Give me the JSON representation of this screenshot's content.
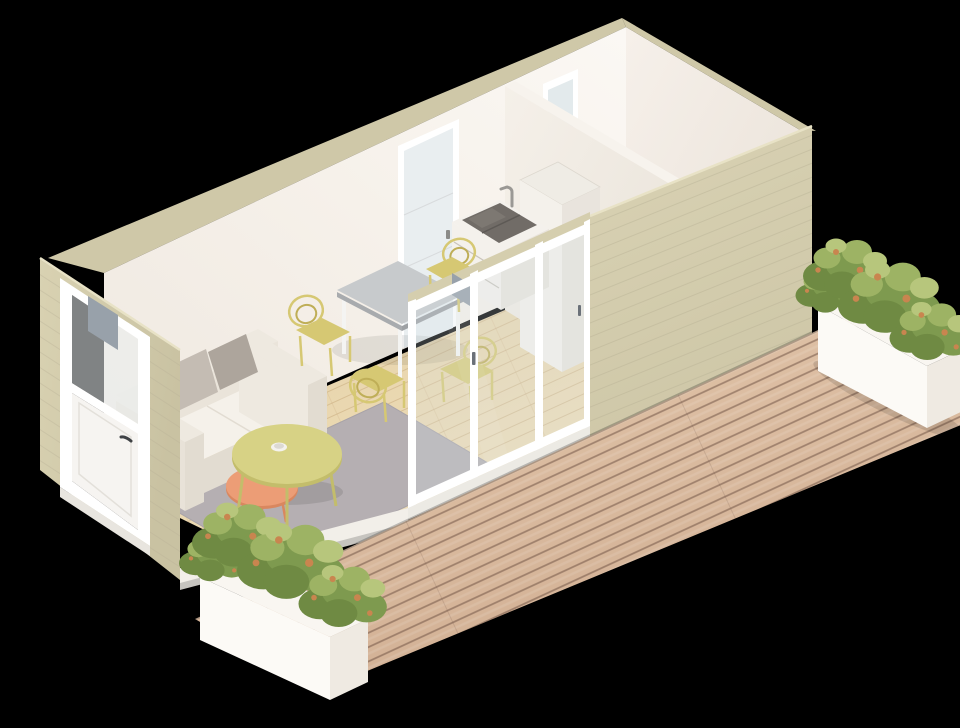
{
  "scene": {
    "description": "3D isometric architectural render of a furnished tiny-home studio with open cutaway walls, kitchenette, storage room and outdoor wooden deck with planters",
    "background": "#000000"
  },
  "colors": {
    "background": "#000000",
    "wall_ext": "#d5ceae",
    "wall_ext_dark": "#cbc4a4",
    "wall_top": "#cfc8a8",
    "wall_int": "#f7f2ec",
    "wall_int_shade": "#efe8e0",
    "partition_top": "#f7f3ed",
    "floor_wood": "#ecdab2",
    "right_room_floor": "#f1e9dc",
    "slab": "#f2efe9",
    "rug": "#b5afb2",
    "sofa_body": "#eee9e0",
    "sofa_seat": "#f5f1ea",
    "sofa_side": "#e2dcd1",
    "pillow_a": "#c4bcb3",
    "pillow_b": "#ada59c",
    "coffee_top": "#d7d285",
    "coffee_side": "#c3bd6b",
    "side_table_top": "#ec9d76",
    "side_table_side": "#d9875f",
    "table_top": "#c7cacc",
    "table_side": "#a8abae",
    "table_leg": "#f4f4f2",
    "chair": "#d6c873",
    "chair_line": "#bfae57",
    "fridge_left": "#f4f1eb",
    "fridge_front": "#e9e4dd",
    "fridge_top": "#efece5",
    "counter": "#f4f1ec",
    "counter_side": "#e9e4dd",
    "sink": "#716c67",
    "sink_divider": "#5d5955",
    "faucet": "#9a9894",
    "door_frame": "#ffffff",
    "door_glass": "#e9eef0",
    "door_panel": "#f6f4f1",
    "handle": "#3f4245",
    "glass": "#d8e4e6",
    "metal_cut": "#98a1aa",
    "deck": "#d9bb9f",
    "deck_gap": "#6e5243",
    "planter_top": "#f9f6f1",
    "planter_face": "#fcfaf6",
    "planter_side": "#efeae2",
    "leaf_dark": "#6f8a43",
    "leaf_mid": "#7e9a4f",
    "leaf_light": "#9db364",
    "leaf_pale": "#b7c67c",
    "leaf_accent": "#c9854f"
  },
  "objects": [
    {
      "id": "living-area",
      "label": "living area with sofa, rug and coffee tables"
    },
    {
      "id": "dining-area",
      "label": "gray dining table with four yellow wire chairs"
    },
    {
      "id": "kitchenette",
      "label": "sink counter and tall fridge along partition wall"
    },
    {
      "id": "storage-room",
      "label": "empty enclosed room at right end"
    },
    {
      "id": "entry-door",
      "label": "white entry door with glass upper half in left wall"
    },
    {
      "id": "interior-door",
      "label": "white frosted glass door in back wall"
    },
    {
      "id": "sliding-door",
      "label": "three panel sliding glass door on front wall"
    },
    {
      "id": "deck-terrace",
      "label": "wooden plank deck with two white planters of shrubs"
    }
  ]
}
